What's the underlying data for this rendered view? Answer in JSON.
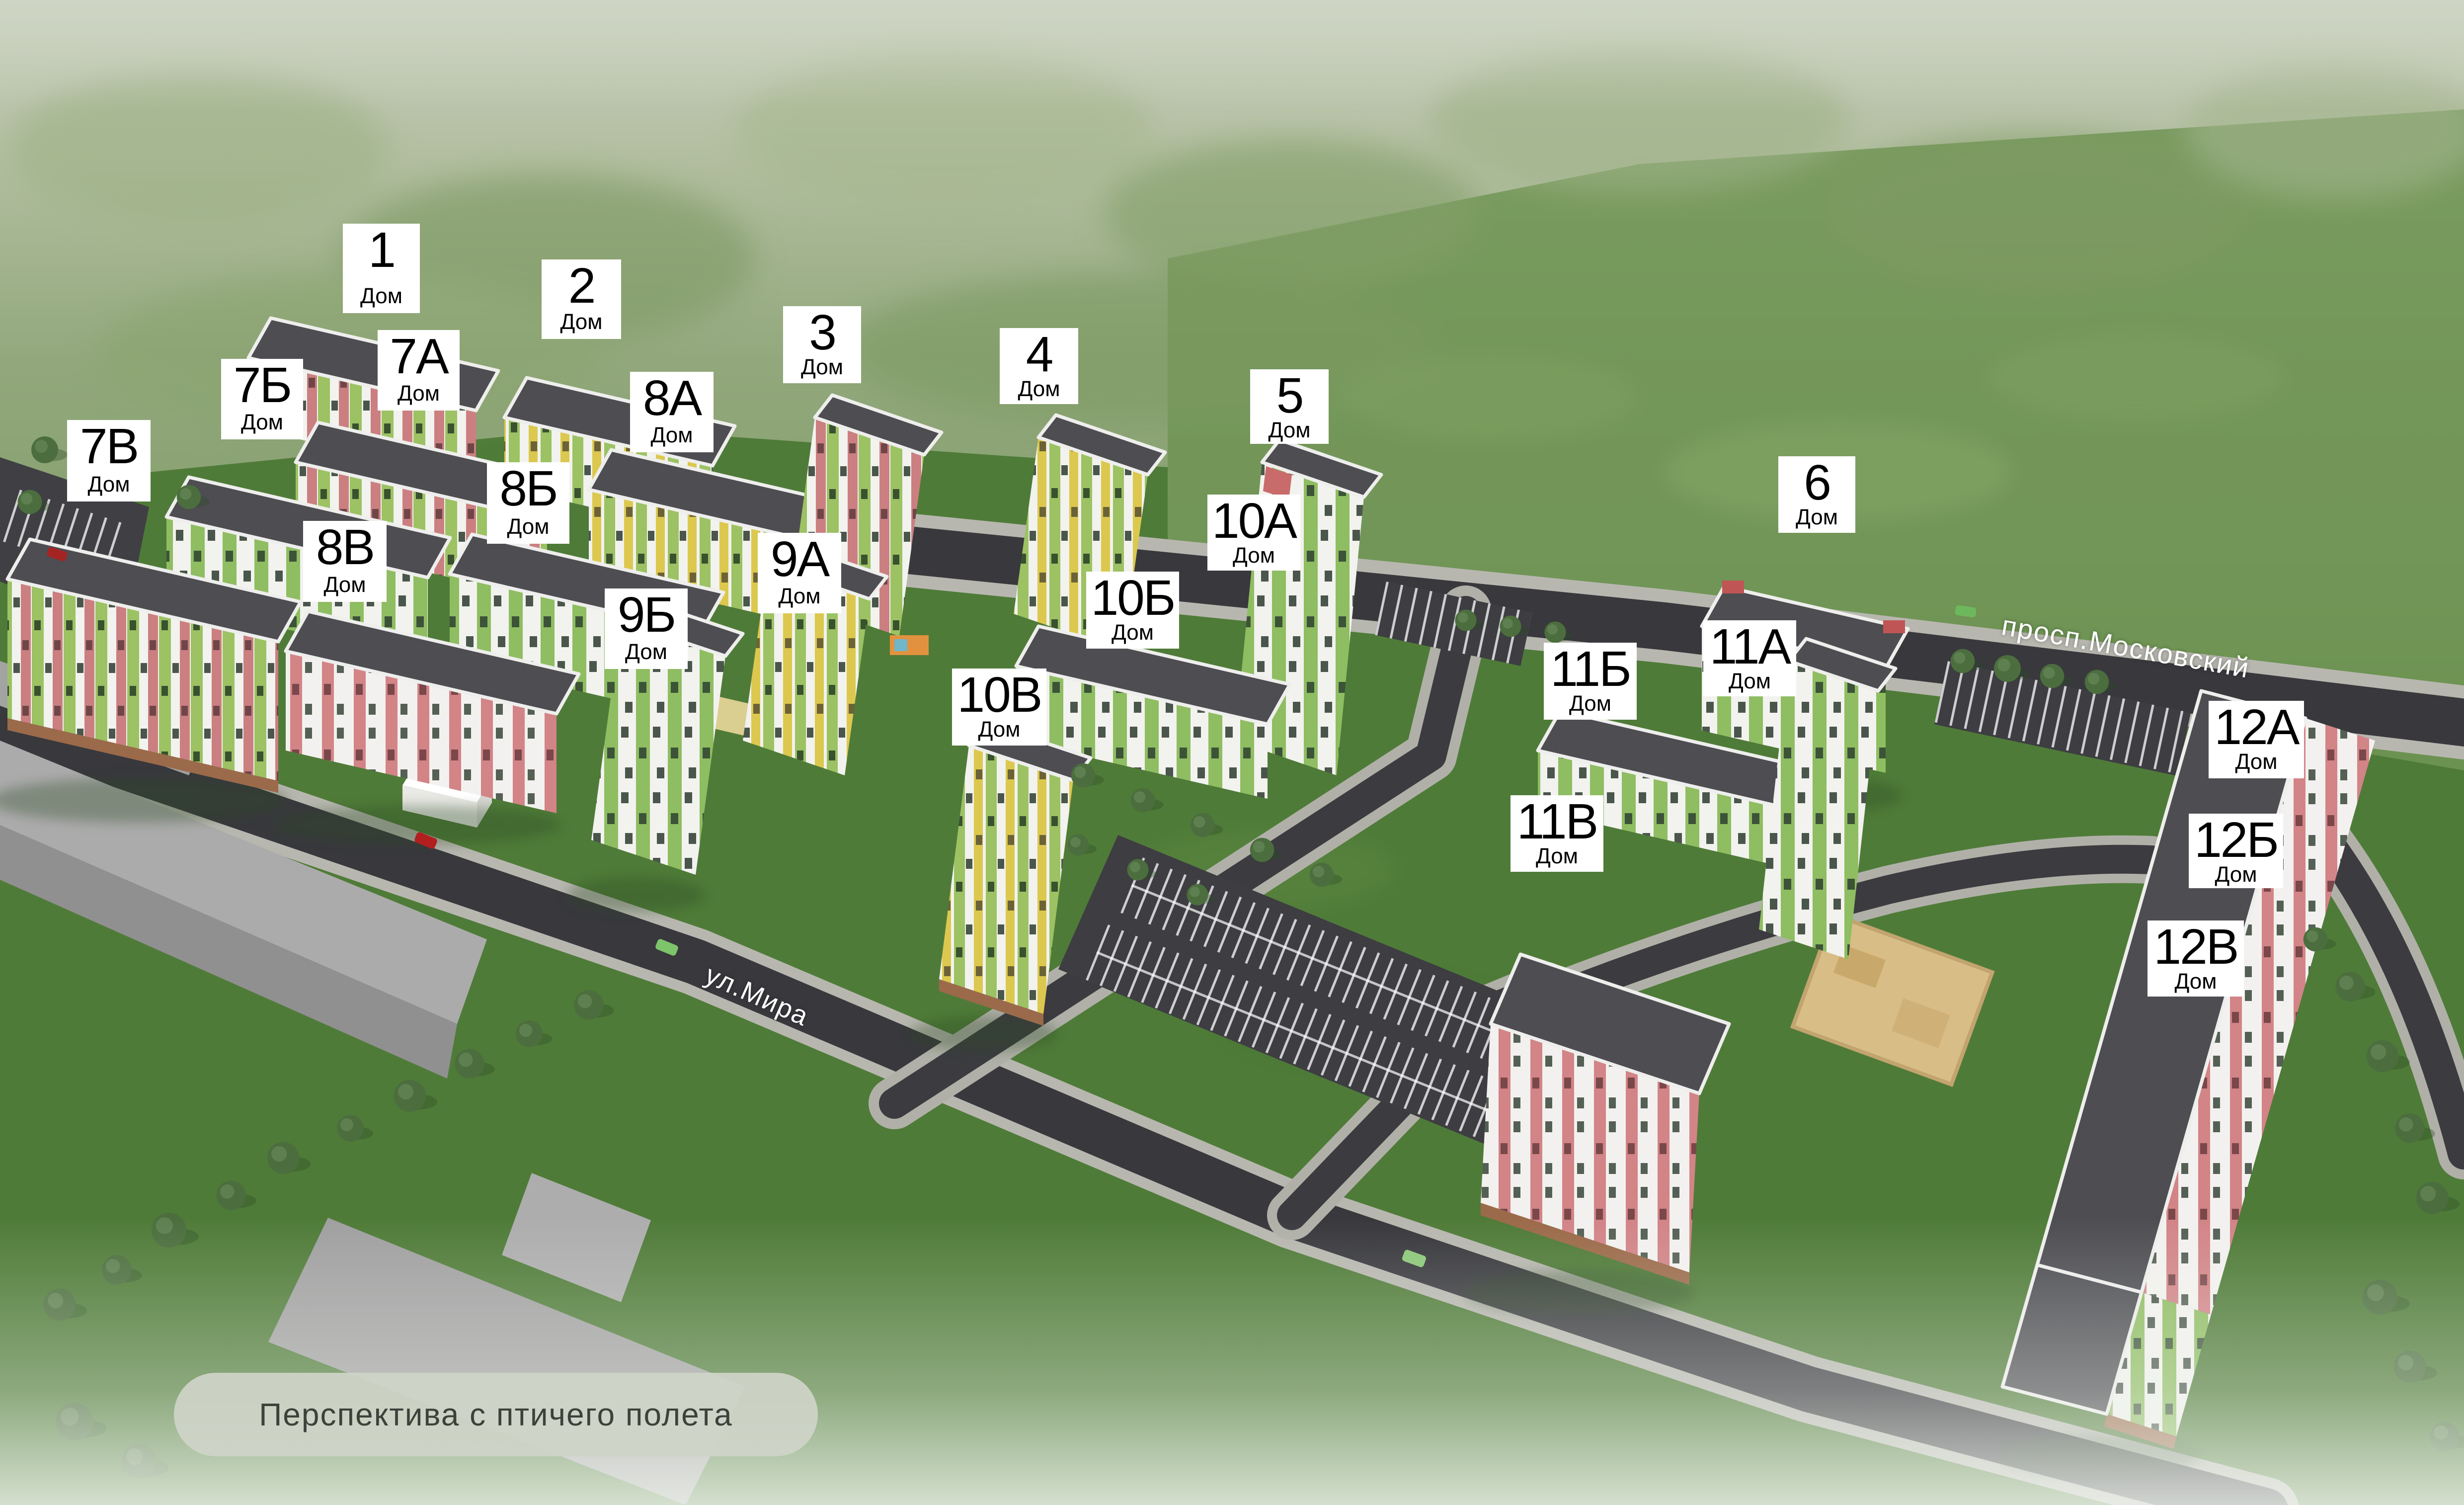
{
  "caption": "Перспектива с птичего полета",
  "streets": [
    {
      "name": "ул.Мира"
    },
    {
      "name": "просп.Московский"
    }
  ],
  "labels": [
    {
      "num": "1",
      "sub": "Дом"
    },
    {
      "num": "2",
      "sub": "Дом"
    },
    {
      "num": "3",
      "sub": "Дом"
    },
    {
      "num": "4",
      "sub": "Дом"
    },
    {
      "num": "5",
      "sub": "Дом"
    },
    {
      "num": "6",
      "sub": "Дом"
    },
    {
      "num": "7А",
      "sub": "Дом"
    },
    {
      "num": "7Б",
      "sub": "Дом"
    },
    {
      "num": "7В",
      "sub": "Дом"
    },
    {
      "num": "8А",
      "sub": "Дом"
    },
    {
      "num": "8Б",
      "sub": "Дом"
    },
    {
      "num": "8В",
      "sub": "Дом"
    },
    {
      "num": "9А",
      "sub": "Дом"
    },
    {
      "num": "9Б",
      "sub": "Дом"
    },
    {
      "num": "10А",
      "sub": "Дом"
    },
    {
      "num": "10Б",
      "sub": "Дом"
    },
    {
      "num": "10В",
      "sub": "Дом"
    },
    {
      "num": "11А",
      "sub": "Дом"
    },
    {
      "num": "11Б",
      "sub": "Дом"
    },
    {
      "num": "11В",
      "sub": "Дом"
    },
    {
      "num": "12А",
      "sub": "Дом"
    },
    {
      "num": "12Б",
      "sub": "Дом"
    },
    {
      "num": "12В",
      "sub": "Дом"
    }
  ],
  "colors": {
    "accent_green": "#8fbd62",
    "accent_yellow": "#dcc84e",
    "accent_pink": "#cb7f81",
    "roof": "#4d4d52",
    "asphalt": "#38383d",
    "sidewalk": "#b7b7af",
    "grass": "#4f7b38",
    "sand": "#d9bd86"
  }
}
